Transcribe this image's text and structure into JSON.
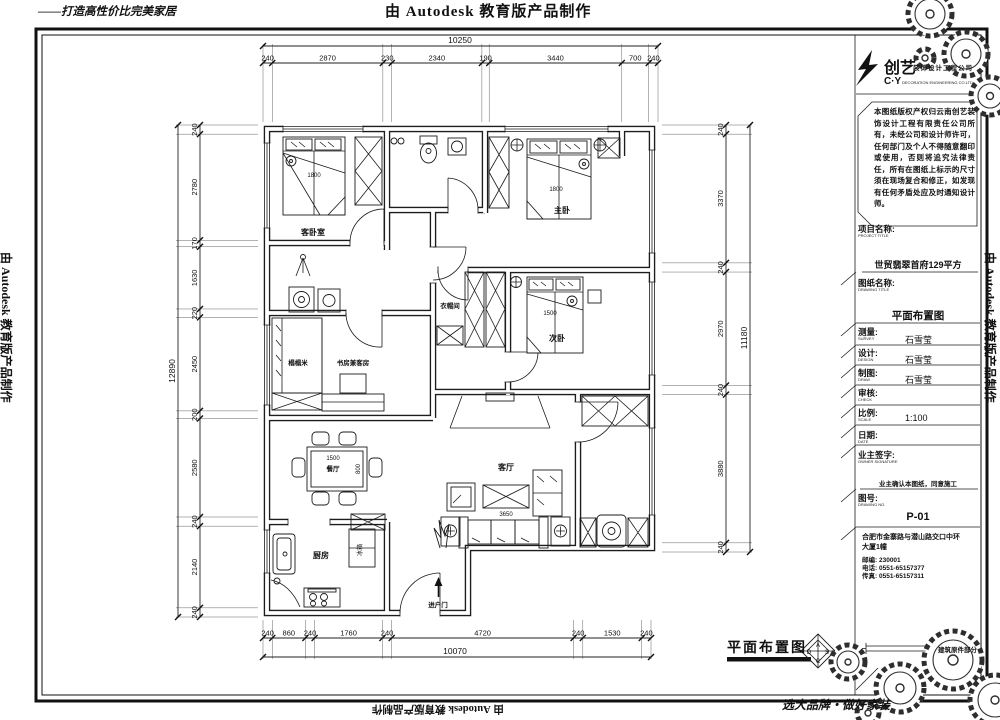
{
  "wm": {
    "top": "由 Autodesk 教育版产品制作",
    "bottom": "由 Autodesk 教育版产品制作",
    "left": "由 Autodesk 教育版产品制作",
    "right": "由 Autodesk 教育版产品制作",
    "tagline_tl": "——打造高性价比完美家居",
    "tagline_br": "选大品牌・做好家装"
  },
  "tb": {
    "company_big": "创艺",
    "company_small": "装饰设计工程公司",
    "company_cy": "C·Y",
    "company_en": "DECORATION ENGINEERING CO.LTD",
    "disclaimer": "本图纸版权产权归云南创艺装饰设计工程有限责任公司所有，未经公司和设计师许可，任何部门及个人不得随意翻印或使用，否则将追究法律责任，所有在图纸上标示的尺寸须在现场复合和修正，如发现有任何矛盾处应及时通知设计师。",
    "project_label": "项目名称:",
    "project_en": "PROJECT TITLE",
    "project_name": "世贸翡翠首府129平方",
    "drawing_label": "图纸名称:",
    "drawing_en": "DRAWING TITLE",
    "drawing_name": "平面布置图",
    "rows": [
      {
        "label": "测量:",
        "en": "SURVEY",
        "value": "石雪莹"
      },
      {
        "label": "设计:",
        "en": "DESIGN",
        "value": "石雪莹"
      },
      {
        "label": "制图:",
        "en": "DRAW",
        "value": "石雪莹"
      },
      {
        "label": "审核:",
        "en": "CHECK",
        "value": ""
      },
      {
        "label": "比例:",
        "en": "SCALE",
        "value": "1:100"
      },
      {
        "label": "日期:",
        "en": "DATE",
        "value": ""
      }
    ],
    "owner_label": "业主签字:",
    "owner_en": "OWNER SIGNATURE",
    "owner_confirm": "业主确认本图纸，同意施工",
    "no_label": "图号:",
    "no_en": "DRAWING NO.",
    "drawing_no": "P-01",
    "addr1": "合肥市金寨路与潜山路交口中环",
    "addr2": "大厦1幢",
    "zip": "邮编: 230001",
    "tel": "电话: 0551-65157377",
    "fax": "传真: 0551-65157311",
    "legend": "建筑原件部分"
  },
  "footer": {
    "plan_title": "平面布置图",
    "logo_letters": [
      "A",
      "D",
      "S",
      "C"
    ]
  },
  "plan": {
    "rooms": {
      "guest_bedroom": "客卧室",
      "master_bedroom": "主卧",
      "second_bedroom": "次卧",
      "cloakroom": "衣帽间",
      "tatami": "榻榻米",
      "study_guest": "书房兼客房",
      "dining": "餐厅",
      "kitchen": "厨房",
      "living": "客厅",
      "entry_door": "进户门",
      "fridge": "冰箱"
    },
    "furn": {
      "guest_bed": "1800",
      "master_bed": "1800",
      "second_bed": "1500",
      "dining_table_l": "1500",
      "dining_table_w": "800",
      "sofa": "3650"
    }
  },
  "dimensions": {
    "top": {
      "total": "10250",
      "segments": [
        "240",
        "2870",
        "230",
        "2340",
        "190",
        "3440",
        "700",
        "240"
      ]
    },
    "bottom": {
      "total": "10070",
      "segments": [
        "240",
        "860",
        "240",
        "1760",
        "240",
        "4720",
        "240",
        "1530",
        "240"
      ]
    },
    "left": {
      "total": "12890",
      "segments": [
        "240",
        "2780",
        "170",
        "1630",
        "220",
        "2450",
        "200",
        "2580",
        "240",
        "2140",
        "240"
      ]
    },
    "right": {
      "total": "11180",
      "segments": [
        "240",
        "3370",
        "240",
        "2970",
        "240",
        "3880",
        "240"
      ]
    }
  }
}
